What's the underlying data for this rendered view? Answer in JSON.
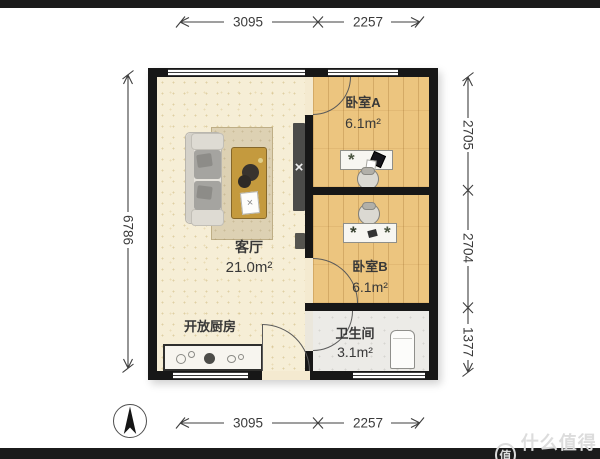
{
  "rooms": {
    "living": {
      "name": "客厅",
      "area": "21.0m²"
    },
    "kitchen": {
      "name": "开放厨房"
    },
    "bedroom_a": {
      "name": "卧室A",
      "area": "6.1m²"
    },
    "bedroom_b": {
      "name": "卧室B",
      "area": "6.1m²"
    },
    "bathroom": {
      "name": "卫生间",
      "area": "3.1m²"
    }
  },
  "dims": {
    "top_left": "3095",
    "top_right": "2257",
    "bottom_left": "3095",
    "bottom_right": "2257",
    "left": "6786",
    "right_top": "2705",
    "right_middle": "2704",
    "right_bottom": "1377"
  },
  "watermark": {
    "logo": "值",
    "text": "什么值得买"
  },
  "icons": {
    "compass": "north-arrow"
  },
  "colors": {
    "wall": "#171717",
    "living_floor": "#f6eed6",
    "wood_floor": "#ecc57f",
    "bath_floor": "#ecebe7",
    "rug": "#ddd1b3",
    "coffee_table": "#c49a3e",
    "tv_unit": "#4b4b49",
    "dimension_lines": "#3f3f3f",
    "page_bars": "#1b1b1b",
    "watermark": "#dcdcdc"
  }
}
